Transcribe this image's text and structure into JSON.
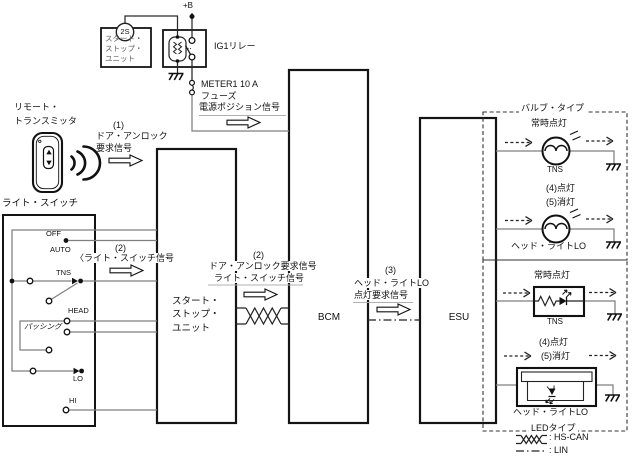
{
  "power_supply": {
    "battery": "+B",
    "connector": "2S",
    "unit_ref": {
      "r1": "スタート・",
      "r2": "ストップ・",
      "r3": "ユニット"
    },
    "relay": "IG1リレー",
    "fuse_name": "METER1 10 A",
    "fuse_word": "フューズ",
    "signal": "電源ポジション信号"
  },
  "remote": {
    "name1": "リモート・",
    "name2": "トランスミッタ",
    "step": "(1)",
    "sig1": "ドア・アンロック",
    "sig2": "要求信号"
  },
  "light_switch": {
    "title": "ライト・スイッチ",
    "off": "OFF",
    "auto": "AUTO",
    "tns": "TNS",
    "head": "HEAD",
    "passing": "パッシング",
    "lo": "LO",
    "hi": "HI",
    "step": "(2)",
    "signal": "〈ライト・スイッチ信号"
  },
  "start_stop_unit": {
    "l1": "スタート・",
    "l2": "ストップ・",
    "l3": "ユニット"
  },
  "can_bus": {
    "step": "(2)",
    "sig1": "ドア・アンロック要求信号",
    "sig2": "ライト・スイッチ信号"
  },
  "bcm": "BCM",
  "lin_bus": {
    "step": "(3)",
    "sig1": "ヘッド・ライトLO",
    "sig2": "点灯要求信号"
  },
  "esu": "ESU",
  "bulb_type": {
    "title": "バルブ・タイプ",
    "tns_note": "常時点灯",
    "tns": "TNS",
    "head_note1": "(4)点灯",
    "head_note2": "(5)消灯",
    "head": "ヘッド・ライトLO"
  },
  "led_type": {
    "title": "LEDタイプ",
    "tns_note": "常時点灯",
    "tns": "TNS",
    "head_note1": "(4)点灯",
    "head_note2": "(5)消灯",
    "head": "ヘッド・ライトLO"
  },
  "legend": {
    "hs_can": ": HS-CAN",
    "lin": ": LIN"
  }
}
